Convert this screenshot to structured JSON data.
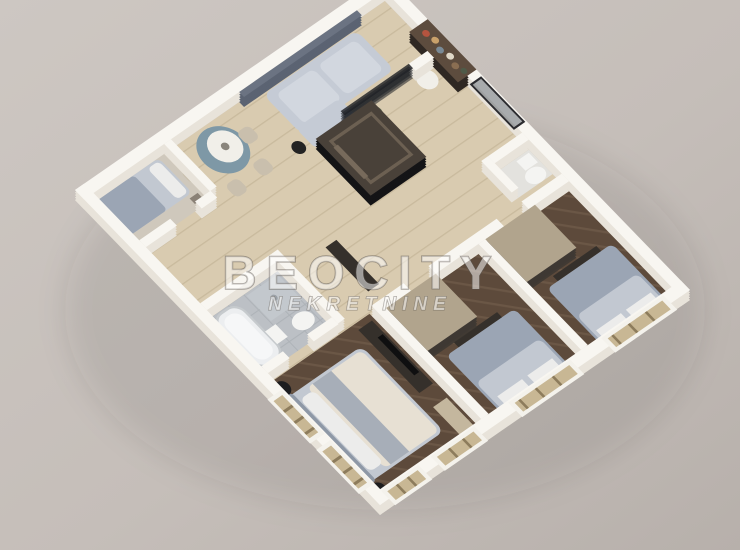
{
  "watermark": {
    "title": "BEOCITY",
    "subtitle": "NEKRETNINE"
  },
  "scene": {
    "description": "3D isometric cutaway floor plan render of an apartment: living room with gray sofa and round teal dining table, central dark entry core, three bedrooms with gray beds and glass wardrobes, two bathrooms, wood and herringbone floors, windows along the lower walls"
  },
  "palette": {
    "bg1": "#cdc7c2",
    "bg2": "#b7b0ab",
    "wallTop": "#f8f6f1",
    "wallSide": "#e8e3da",
    "woodL": "#d9cbb0",
    "woodLine": "#c9ba9d",
    "woodD": "#5d4a3b",
    "woodDLine": "#6b5746",
    "tile": "#bcc0c5",
    "tileLine": "#aeb3b8",
    "tileLight": "#e3e2de",
    "smallFloor": "#cfc8bc",
    "coreSide": "#141416",
    "coreTop": "#494139",
    "shelfSide": "#2f2823",
    "shelfTop": "#5d4c3e",
    "partSide": "rgba(30,32,38,0.55)",
    "partTop": "rgba(28,30,35,0.8)",
    "wainsSide": "#5b6372",
    "wainsTop": "#6b7382",
    "wardSide": "rgba(62,57,51,0.9)",
    "wardTop": "#b1a48d",
    "sofa": "#c5cbd5",
    "cushion": "#d2d7df",
    "bedBlue": "#9ba5b4",
    "mattress": "#c2c8d1",
    "pillow": "#ececeb",
    "headboard": "#8e98a6",
    "duvet": "#e7e0d3",
    "throw": "#a7aeb8",
    "teal": "#7e98a6",
    "lamp": "#f1efe9",
    "chair": "#c9bfad",
    "dark": "#35302b",
    "beige": "#c4b79e",
    "winFrame": "#f4f2ec",
    "winTan": "#c8b794",
    "winLine": "#8d7c5c",
    "wm": "rgba(255,255,255,0.52)",
    "wmStroke": "rgba(90,84,78,0.5)"
  }
}
